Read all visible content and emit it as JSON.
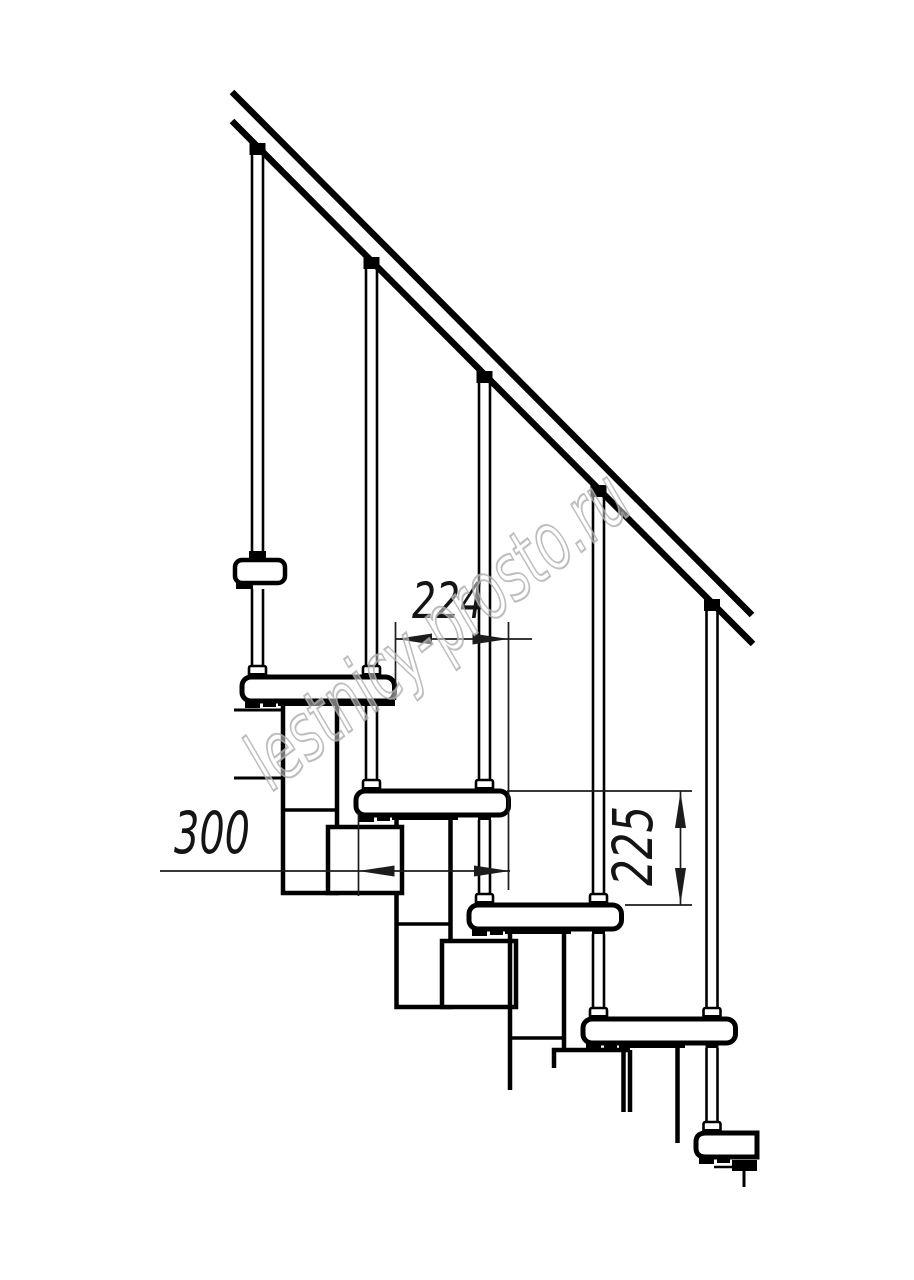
{
  "drawing": {
    "type": "technical-drawing",
    "subject": "modular staircase side elevation with handrail",
    "dimensions": {
      "step_run": "224",
      "tread_depth": "300",
      "step_rise": "225"
    },
    "watermark": "lestnicy-prosto.ru",
    "colors": {
      "line": "#000000",
      "dimension": "#141414",
      "watermark_stroke": "#aeaeae",
      "background": "#ffffff"
    }
  }
}
